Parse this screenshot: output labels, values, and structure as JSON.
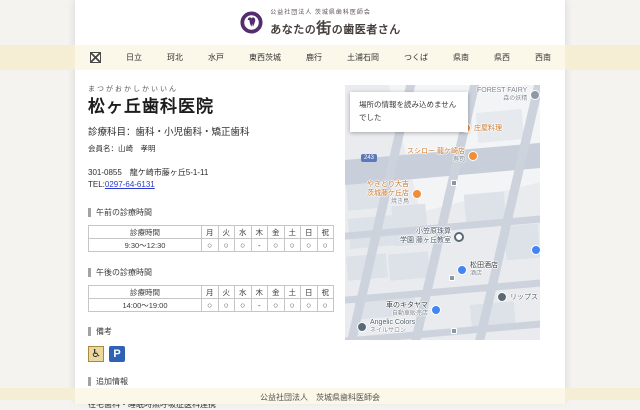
{
  "header": {
    "org": "公益社団法人 茨城県歯科医師会",
    "brand_pre": "あなたの",
    "brand_emphasis": "街",
    "brand_post": "の歯医者さん"
  },
  "nav": {
    "items": [
      "日立",
      "珂北",
      "水戸",
      "東西茨城",
      "鹿行",
      "土浦石岡",
      "つくば",
      "県南",
      "県西",
      "西南"
    ]
  },
  "clinic": {
    "kana": "まつがおかしかいいん",
    "name": "松ヶ丘歯科医院",
    "departments": "診療科目：歯科・小児歯科・矯正歯科",
    "member": "会員名：山崎　孝明",
    "address": "301-0855　龍ケ崎市藤ヶ丘5-1-11",
    "tel_label": "TEL:",
    "tel_number": "0297-64-6131"
  },
  "sections": {
    "morning": "午前の診療時間",
    "afternoon": "午後の診療時間",
    "remarks": "備考",
    "additional_info": "追加情報"
  },
  "schedule": {
    "columns": [
      "診療時間",
      "月",
      "火",
      "水",
      "木",
      "金",
      "土",
      "日",
      "祝"
    ],
    "morning": [
      "9:30～12:30",
      "○",
      "○",
      "○",
      "-",
      "○",
      "○",
      "○",
      "○"
    ],
    "afternoon": [
      "14:00～19:00",
      "○",
      "○",
      "○",
      "-",
      "○",
      "○",
      "○",
      "○"
    ]
  },
  "remarks": {
    "wheelchair_symbol": "♿",
    "parking_label": "P"
  },
  "additional": {
    "text": "在宅歯科・睡眠時無呼吸症医科連携"
  },
  "map": {
    "error_line1": "場所の情報を読み込めません",
    "error_line2": "でした",
    "route_badge": "243",
    "pois": {
      "forest": {
        "name": "FOREST FAIRY",
        "sub": "森の妖精"
      },
      "shoya": {
        "name": "庄屋料理"
      },
      "sushiro": {
        "name": "スシロー 龍ケ崎店",
        "sub": "寿司"
      },
      "yakitori": {
        "line1": "やきとり大吉",
        "line2": "茨城藤ケ丘店",
        "sub": "焼き鳥"
      },
      "ogasawara": {
        "line1": "小笠原珠算",
        "line2": "学園 藤ヶ丘教室"
      },
      "matsuda": {
        "name": "松田酒店",
        "sub": "酒店"
      },
      "lips": {
        "name": "リップス"
      },
      "kitayama": {
        "name": "車のキタヤマ",
        "sub": "自動車販売店"
      },
      "angelic": {
        "name": "Angelic Colors",
        "sub": "ネイルサロン"
      }
    }
  },
  "footer": {
    "text": "公益社団法人　茨城県歯科医師会"
  },
  "colors": {
    "accent_purple": "#532d6d",
    "band_cream": "#f6eed4",
    "link_blue": "#2b3bce",
    "poi_orange": "#ef8e37",
    "poi_blue": "#4285f4"
  }
}
